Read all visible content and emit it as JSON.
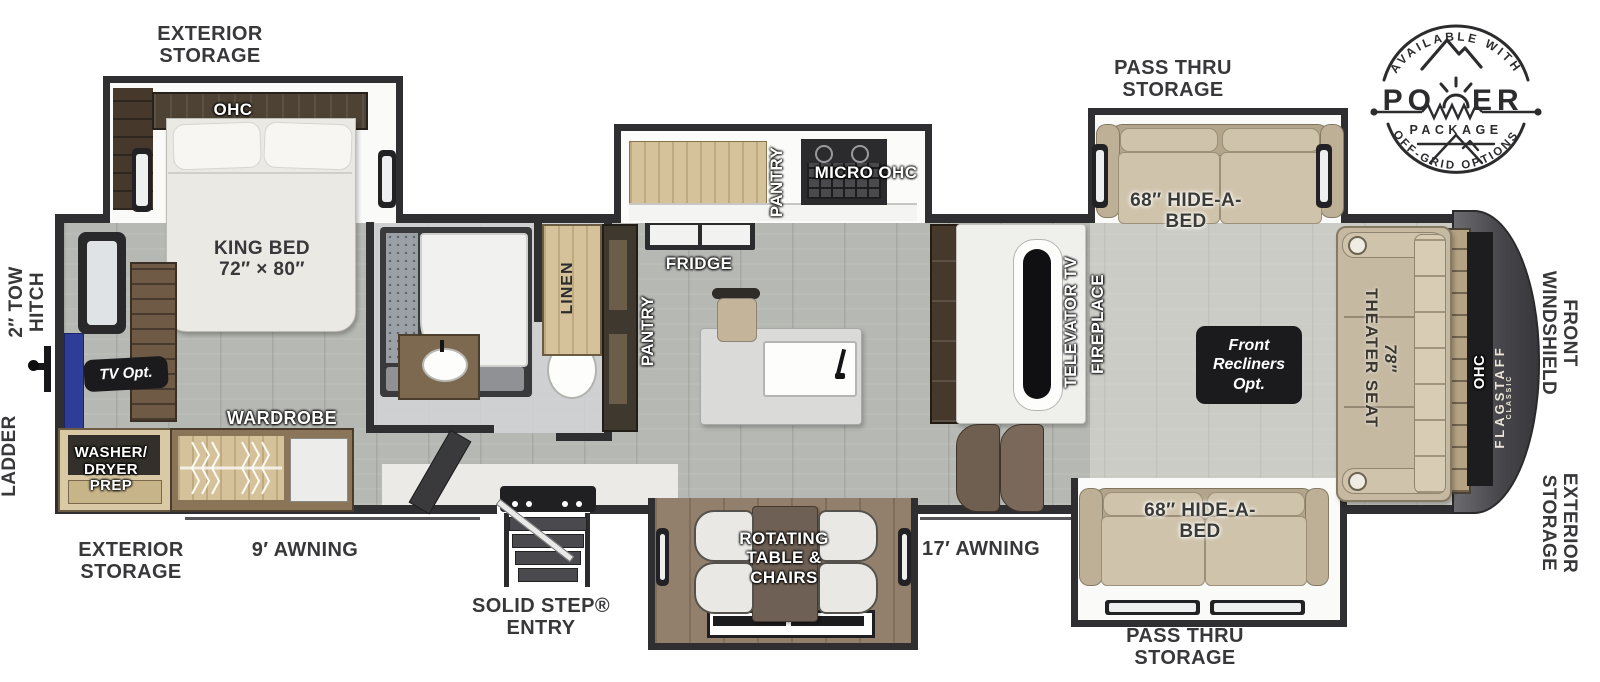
{
  "colors": {
    "wall": "#2f2f31",
    "floor": "#b6b8b3",
    "label_dark": "#38383a",
    "sofa_tan": "#c6b9a0",
    "wood_dark": "#46392c",
    "wood_tan": "#d5c29a",
    "tv_blue": "#2e3d96",
    "front_cap_gray": "#47474b",
    "callout_bg": "#1b1b1d"
  },
  "badge": {
    "top_arc": "AVAILABLE WITH",
    "word_left": "PO",
    "word_right": "ER",
    "package": "PACKAGE",
    "bottom_arc": "OFF-GRID OPTIONS"
  },
  "labels": {
    "exterior_storage_top": "EXTERIOR\nSTORAGE",
    "ohc_bedroom": "OHC",
    "king_bed": "KING BED\n72″ × 80″",
    "tow_hitch": "2″ TOW\nHITCH",
    "ladder": "LADDER",
    "tv_opt": "TV Opt.",
    "wardrobe": "WARDROBE",
    "washer_dryer": "WASHER/\nDRYER\nPREP",
    "exterior_storage_bottom": "EXTERIOR\nSTORAGE",
    "awning_9": "9′ AWNING",
    "solid_step": "SOLID STEP®\nENTRY",
    "linen": "LINEN",
    "pantry_lower": "PANTRY",
    "pantry_upper": "PANTRY",
    "micro_ohc": "MICRO OHC",
    "fridge": "FRIDGE",
    "rotating_table": "ROTATING\nTABLE &\nCHAIRS",
    "awning_17": "17′ AWNING",
    "televator_tv": "TELEVATOR TV",
    "fireplace": "FIREPLACE",
    "pass_thru_top": "PASS THRU\nSTORAGE",
    "pass_thru_bottom": "PASS THRU\nSTORAGE",
    "hide_a_bed_top": "68″ HIDE-A-\nBED",
    "hide_a_bed_bottom": "68″ HIDE-A-\nBED",
    "front_recliners": "Front\nRecliners\nOpt.",
    "theater_size": "78″",
    "theater_seat": "THEATER SEAT",
    "ohc_front": "OHC",
    "flagstaff": "FLAGSTAFF",
    "flagstaff_sub": "CLASSIC",
    "front_windshield": "FRONT\nWINDSHIELD",
    "exterior_storage_right": "EXTERIOR\nSTORAGE"
  }
}
